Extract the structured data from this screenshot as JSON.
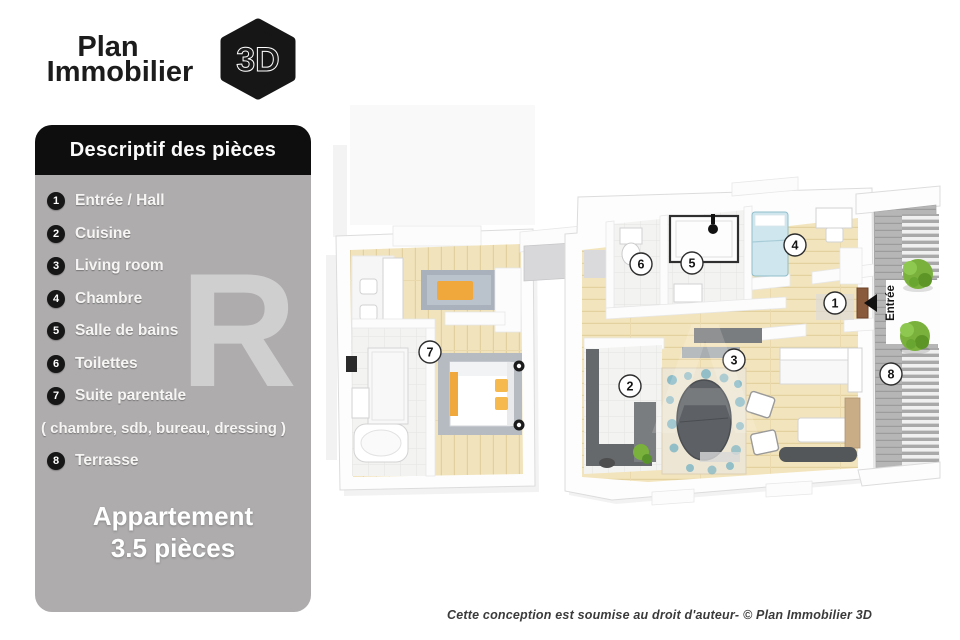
{
  "logo": {
    "line1": "Plan",
    "line2": "Immobilier",
    "badge": "3D"
  },
  "panel": {
    "header": "Descriptif des pièces",
    "items": [
      {
        "number": "1",
        "label": "Entrée / Hall"
      },
      {
        "number": "2",
        "label": "Cuisine"
      },
      {
        "number": "3",
        "label": "Living room"
      },
      {
        "number": "4",
        "label": "Chambre"
      },
      {
        "number": "5",
        "label": "Salle de bains"
      },
      {
        "number": "6",
        "label": "Toilettes"
      },
      {
        "number": "7",
        "label": "Suite parentale"
      },
      {
        "number": "8",
        "label": "Terrasse"
      }
    ],
    "subnote": "( chambre, sdb, bureau, dressing )",
    "title_line1": "Appartement",
    "title_line2": "3.5 pièces"
  },
  "plan": {
    "markers": [
      "1",
      "2",
      "3",
      "4",
      "5",
      "6",
      "7",
      "8"
    ],
    "entrance_label": "Entrée"
  },
  "watermark": {
    "letter1": "R",
    "letter2": "A"
  },
  "footer": {
    "copyright": "Cette conception est soumise au droit d'auteur- © Plan Immobilier 3D"
  },
  "colors": {
    "panel_bg": "#aeacac",
    "header_bg": "#0e0e0e",
    "badge_bg": "#161616",
    "floor_beige": "#f1e3bb",
    "accent_orange": "#f0a83c",
    "duvet_blue": "#cfe6ee",
    "teal": "#7ab4c4",
    "bush_green": "#79b13c",
    "deck_gray": "#b6b6b6",
    "door_brown": "#8a5a3c",
    "counter_gray": "#66696c"
  }
}
